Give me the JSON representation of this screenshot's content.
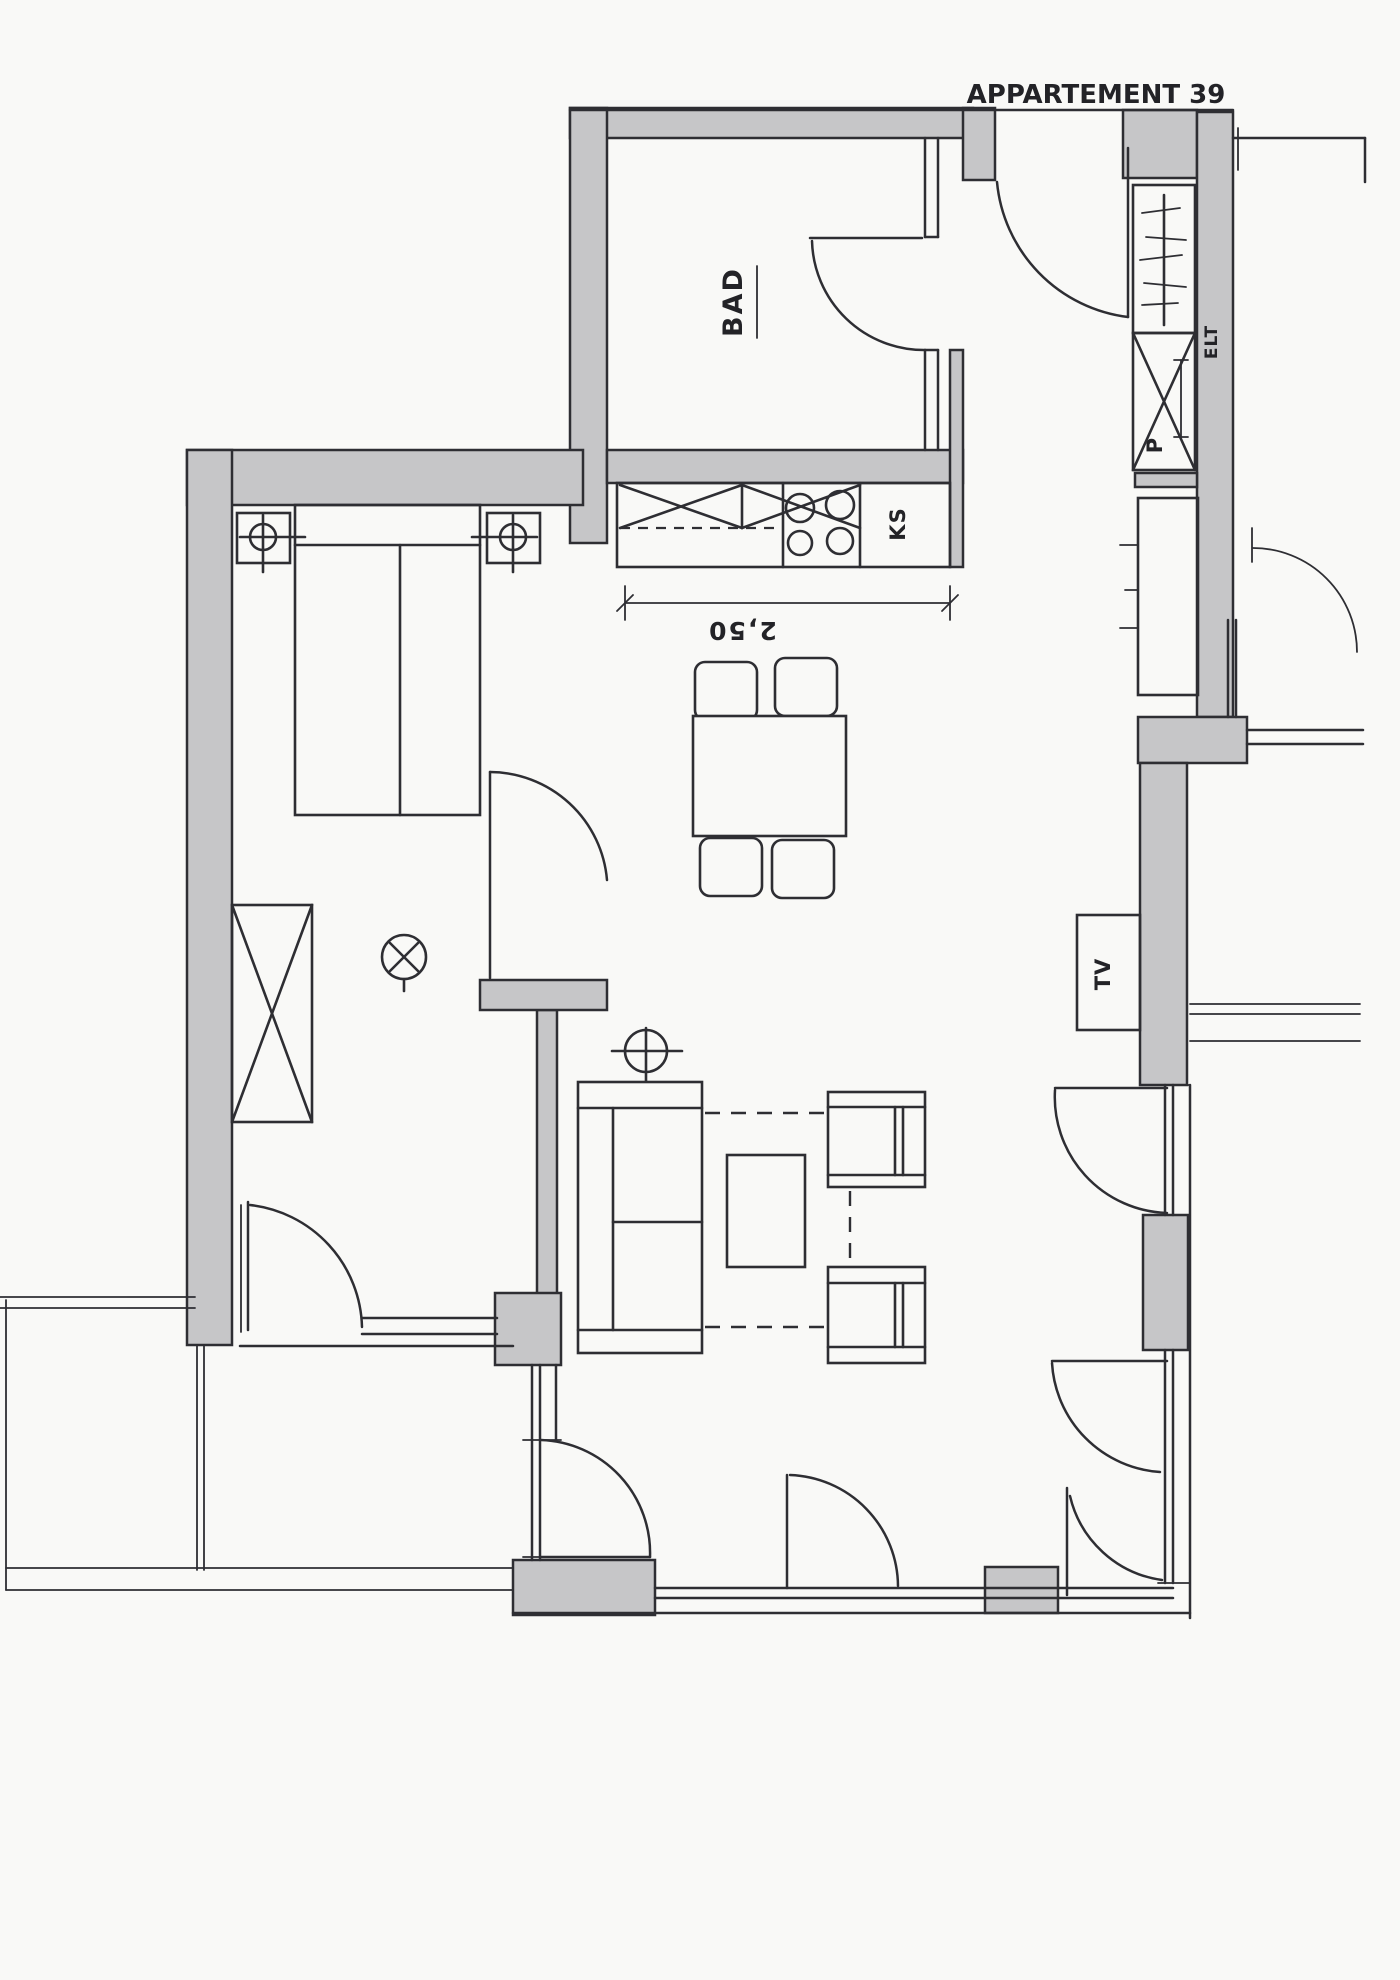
{
  "title": "APPARTEMENT 39",
  "labels": {
    "bathroom": "BAD",
    "fridge": "KS",
    "pantry_closet": "P",
    "electrical": "ELT",
    "tv": "TV"
  },
  "dimensions": {
    "kitchen_counter": "2,50"
  },
  "colors": {
    "wall": "#c6c6c8",
    "line": "#2e2e33",
    "paper": "#f9f9f7"
  }
}
